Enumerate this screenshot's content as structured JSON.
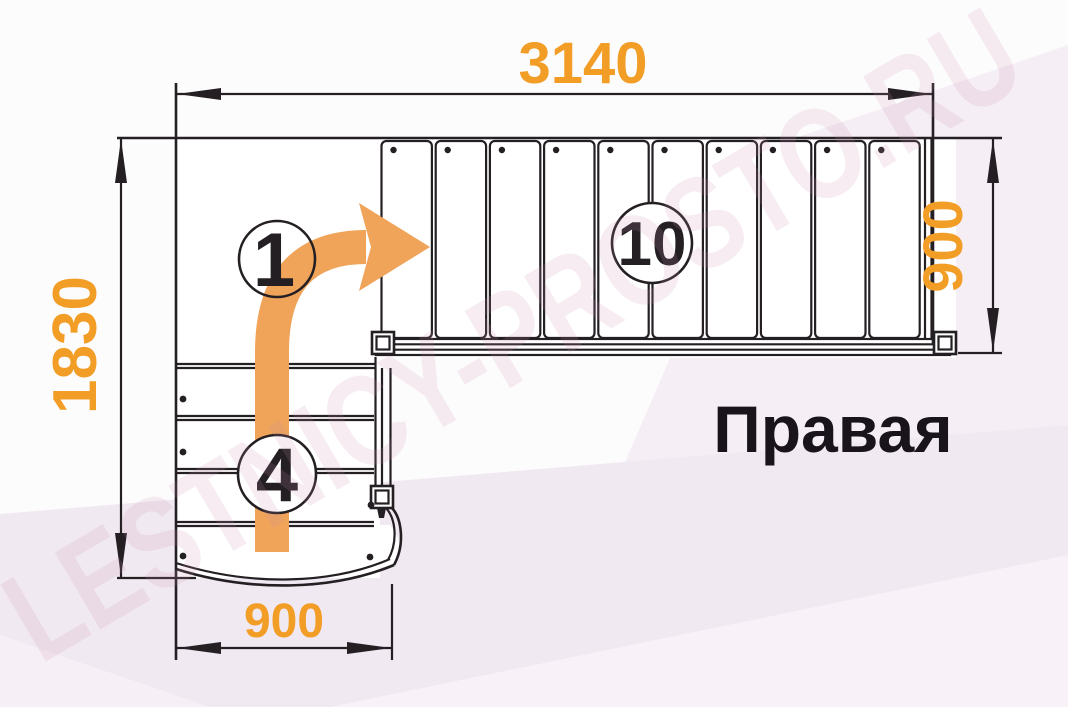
{
  "diagram": {
    "title": "Правая",
    "watermark": "LESTNICY-PROSTO.RU",
    "dimensions": {
      "top_width": "3140",
      "left_height": "1830",
      "right_flight_width": "900",
      "bottom_flight_width": "900"
    },
    "step_labels": {
      "landing": "1",
      "top_flight": "10",
      "lower_flight": "4"
    },
    "counts": {
      "top_flight_treads": 10,
      "lower_flight_treads": 4
    },
    "colors": {
      "dimension_text": "#f29d26",
      "arrow": "#f0a45a",
      "outline": "#241f23",
      "background_tint": "#f1e9f1"
    }
  }
}
